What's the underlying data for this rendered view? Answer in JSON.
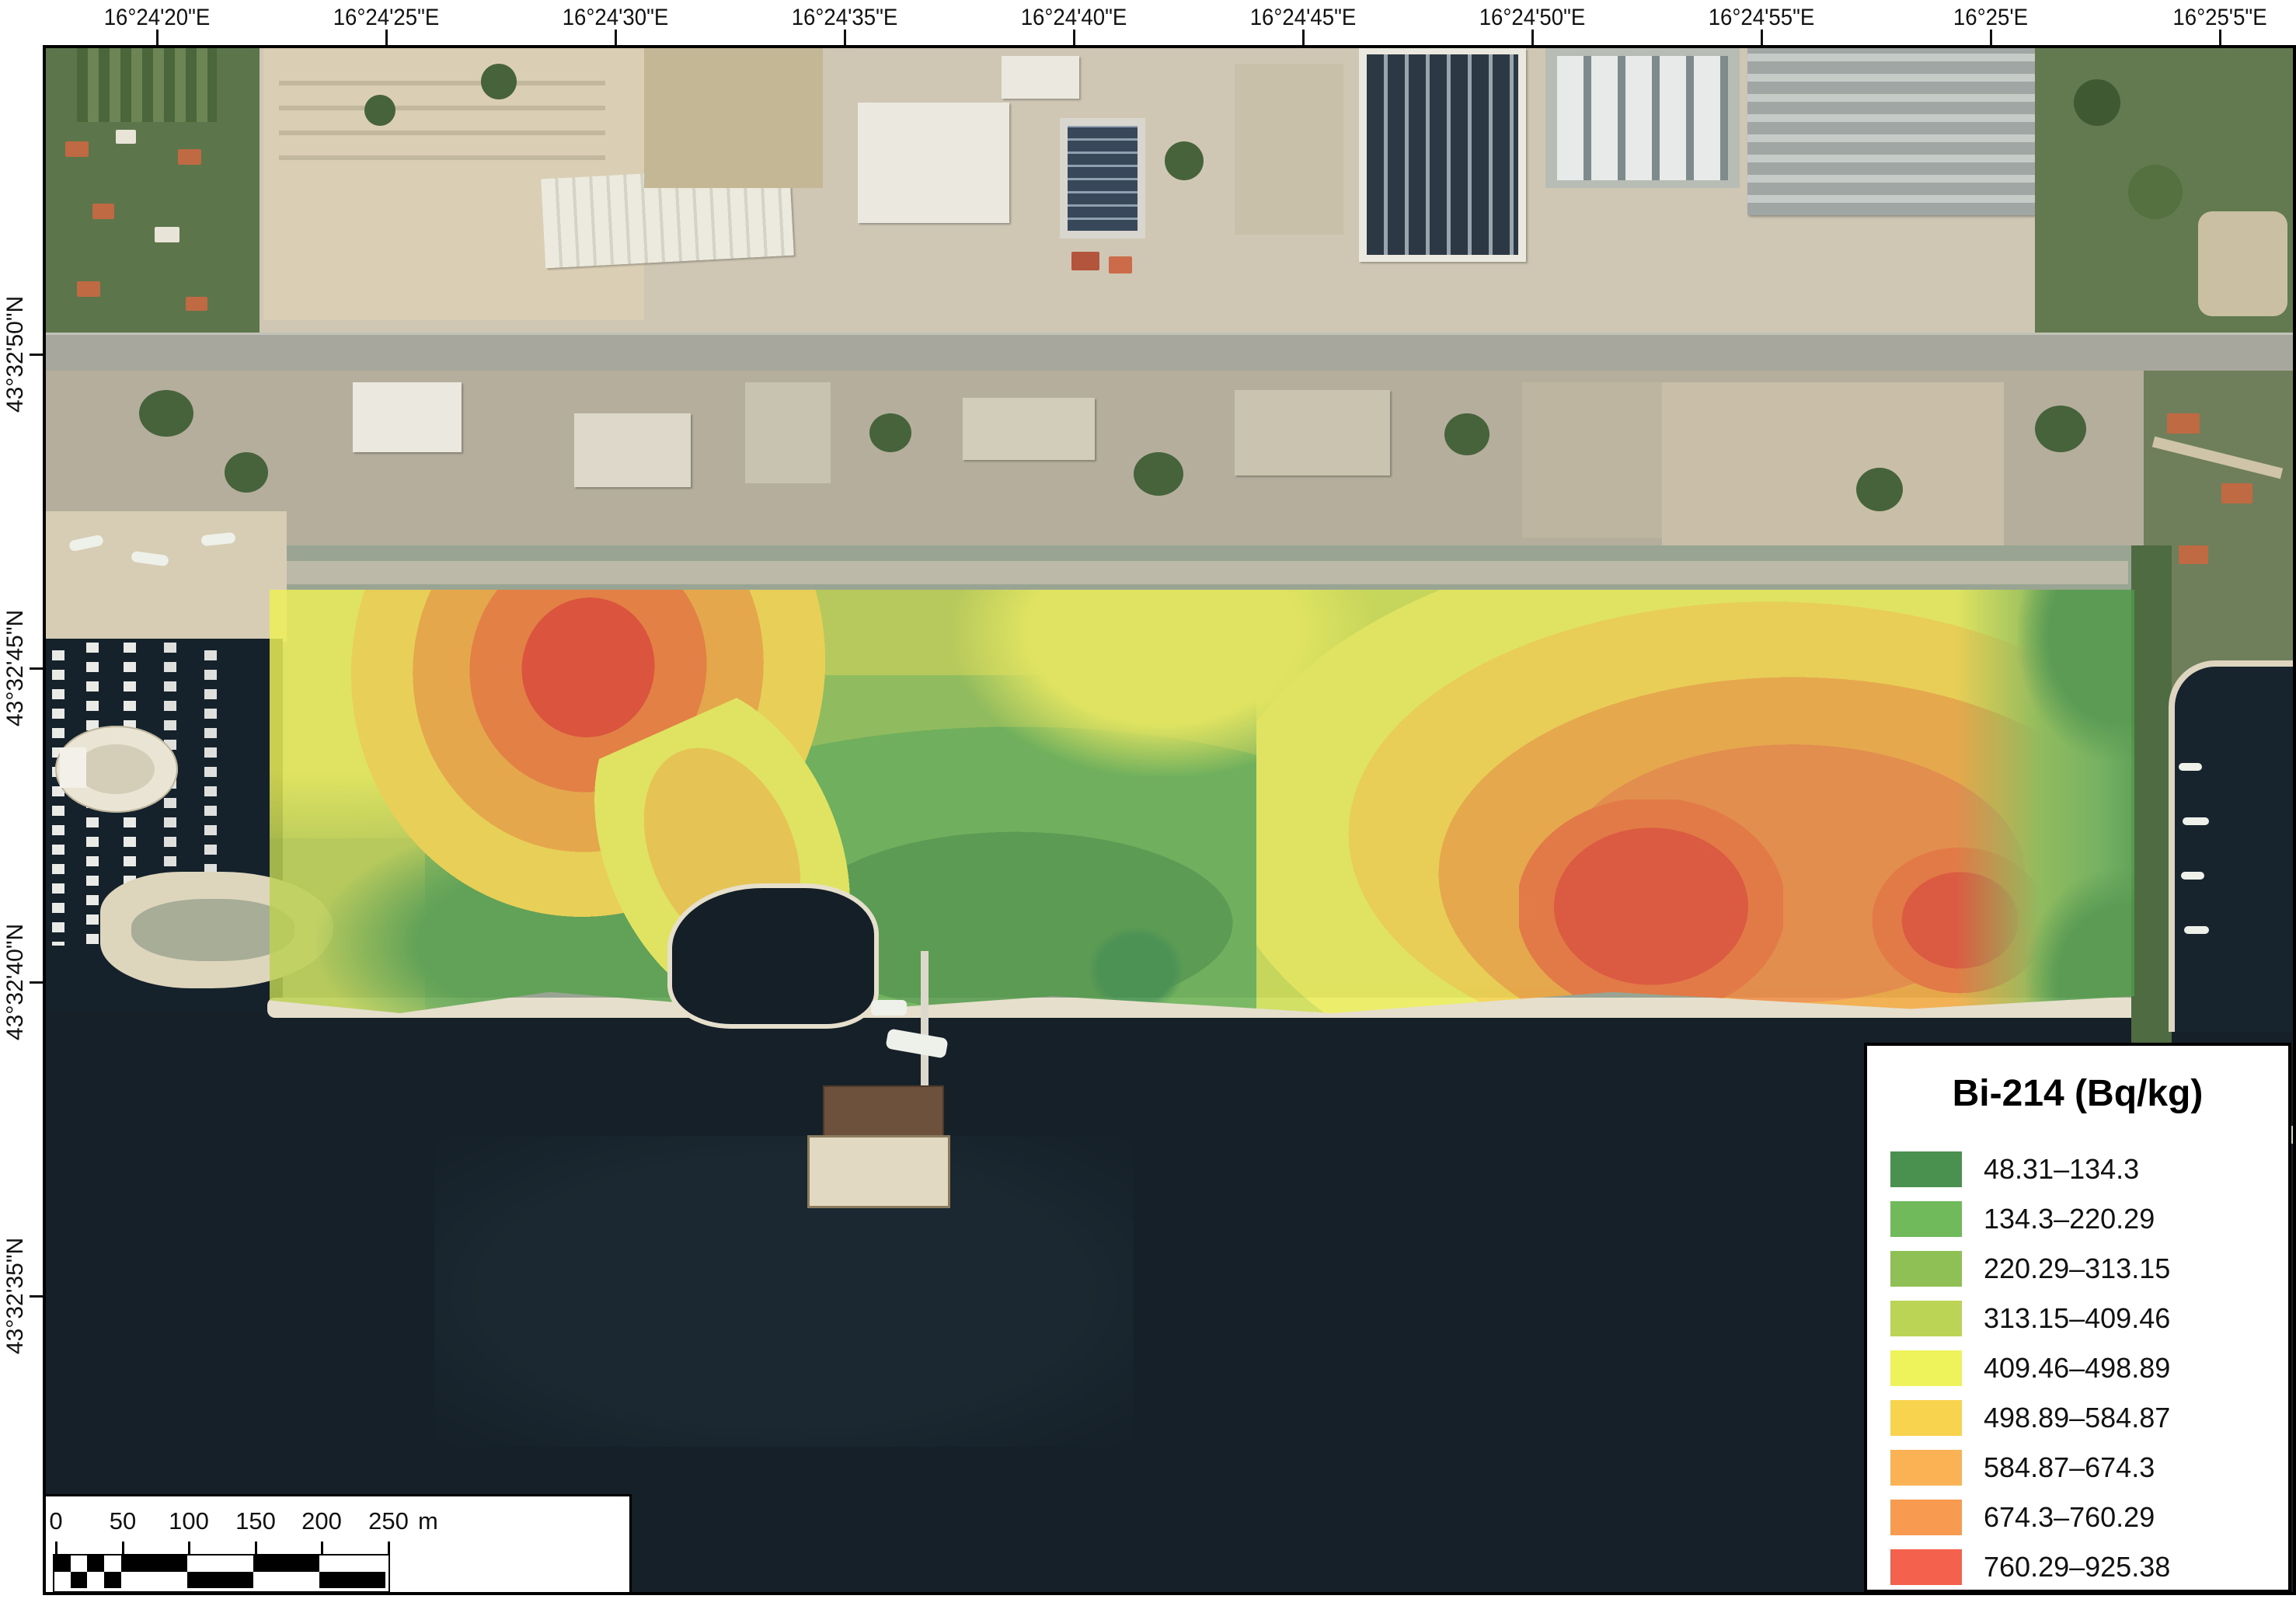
{
  "axes": {
    "top": [
      "16°24'20\"E",
      "16°24'25\"E",
      "16°24'30\"E",
      "16°24'35\"E",
      "16°24'40\"E",
      "16°24'45\"E",
      "16°24'50\"E",
      "16°24'55\"E",
      "16°25'E",
      "16°25'5\"E"
    ],
    "left": [
      "43°32'50\"N",
      "43°32'45\"N",
      "43°32'40\"N",
      "43°32'35\"N"
    ]
  },
  "legend": {
    "title": "Bi-214 (Bq/kg)",
    "classes": [
      {
        "range": "48.31–134.3",
        "color": "#4a9150"
      },
      {
        "range": "134.3–220.29",
        "color": "#71ba5b"
      },
      {
        "range": "220.29–313.15",
        "color": "#8fc055"
      },
      {
        "range": "313.15–409.46",
        "color": "#bcd455"
      },
      {
        "range": "409.46–498.89",
        "color": "#eef25b"
      },
      {
        "range": "498.89–584.87",
        "color": "#f8d44e"
      },
      {
        "range": "584.87–674.3",
        "color": "#fbb254"
      },
      {
        "range": "674.3–760.29",
        "color": "#f89a50"
      },
      {
        "range": "760.29–925.38",
        "color": "#f4624e"
      }
    ]
  },
  "scalebar": {
    "ticks": [
      "0",
      "50",
      "100",
      "150",
      "200",
      "250"
    ],
    "unit": "m"
  }
}
